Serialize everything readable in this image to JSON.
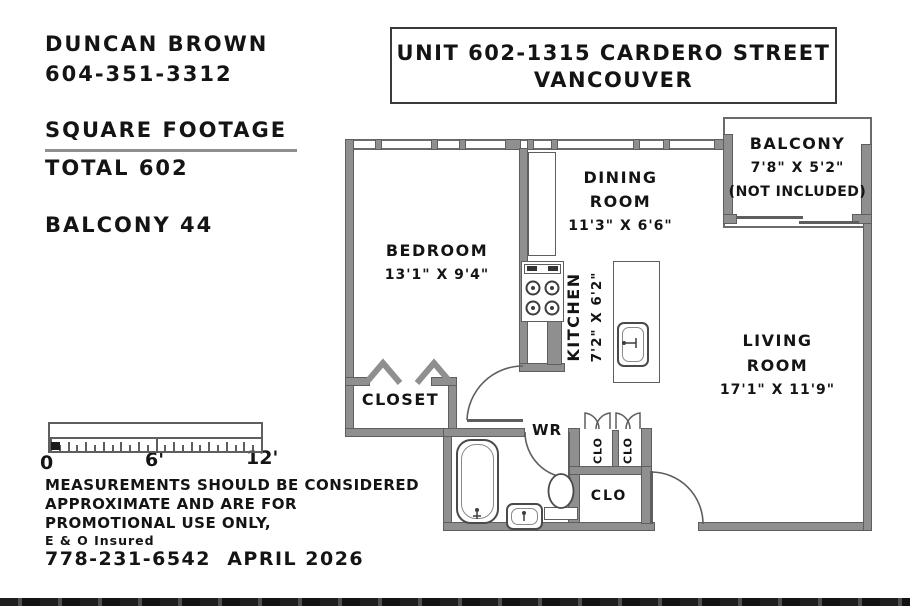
{
  "colors": {
    "wall": "#8f8f8f",
    "line": "#5e5e5e",
    "text": "#141414"
  },
  "agent": {
    "name": "DUNCAN BROWN",
    "phone": "604-351-3312"
  },
  "footage": {
    "heading": "SQUARE FOOTAGE",
    "total": "TOTAL 602",
    "balcony": "BALCONY 44"
  },
  "title": {
    "line1": "UNIT 602-1315 CARDERO STREET",
    "line2": "VANCOUVER"
  },
  "rooms": {
    "balcony": {
      "name": "BALCONY",
      "dims": "7'8\" X 5'2\"",
      "note": "(NOT INCLUDED)"
    },
    "dining": {
      "line1": "DINING",
      "line2": "ROOM",
      "dims": "11'3\" X 6'6\""
    },
    "bedroom": {
      "name": "BEDROOM",
      "dims": "13'1\" X 9'4\""
    },
    "kitchen": {
      "name": "KITCHEN",
      "dims": "7'2\" X 6'2\""
    },
    "living": {
      "line1": "LIVING",
      "line2": "ROOM",
      "dims": "17'1\" X 11'9\""
    },
    "closet": {
      "name": "CLOSET"
    },
    "washroom": {
      "abbr": "WR"
    },
    "closet_small_left": {
      "abbr": "CLO"
    },
    "closet_small_right": {
      "abbr": "CLO"
    },
    "closet_entry": {
      "abbr": "CLO"
    }
  },
  "scale_bar": {
    "label_0": "0",
    "label_mid": "6'",
    "label_end": "12'"
  },
  "disclaimer": {
    "line1": "MEASUREMENTS SHOULD BE CONSIDERED",
    "line2": "APPROXIMATE AND ARE FOR",
    "line3": "PROMOTIONAL USE ONLY,",
    "insurance": "E & O Insured",
    "phone_date": "778-231-6542  APRIL 2026"
  }
}
